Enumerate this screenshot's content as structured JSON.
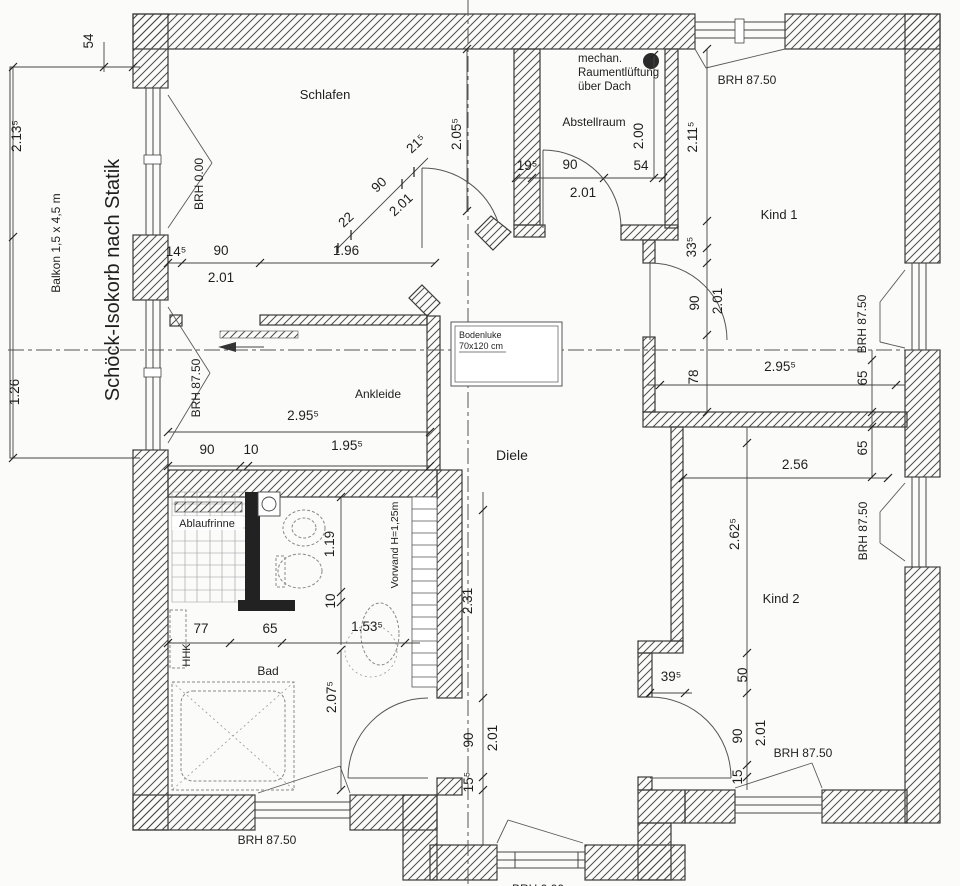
{
  "rooms": {
    "schlafen": "Schlafen",
    "abstellraum": "Abstellraum",
    "kind1": "Kind 1",
    "kind2": "Kind 2",
    "diele": "Diele",
    "ankleide": "Ankleide",
    "bad": "Bad",
    "balkon": "Balkon 1,5 x 4,5 m"
  },
  "annotations": {
    "isokorb": "Schöck-Isokorb nach Statik",
    "vent1": "mechan.",
    "vent2": "Raumentlüftung",
    "vent3": "über Dach",
    "bodenluke1": "Bodenluke",
    "bodenluke2": "70x120 cm",
    "ablaufrinne": "Ablaufrinne",
    "vorwand": "Vorwand H=1,25m",
    "hhk": "HHK"
  },
  "brh": {
    "balkon_tuer": "BRH 0.00",
    "ankleide_fenster": "BRH 87.50",
    "kind1_oben": "BRH 87.50",
    "kind1_rechts": "BRH 87.50",
    "kind2_rechts": "BRH 87.50",
    "kind2_unten": "BRH 87.50",
    "bad_unten": "BRH 87.50",
    "diele_unten": "BRH 0.00"
  },
  "dims": {
    "tl_54": "54",
    "li_2135": "2.13⁵",
    "li_126": "1.26",
    "sch_145": "14⁵",
    "sch_90": "90",
    "sch_196": "1.96",
    "sch_201": "2.01",
    "diag_22": "22",
    "diag_90": "90",
    "diag_215": "21⁵",
    "diag_201": "2.01",
    "ax_2055": "2.05⁵",
    "ab_195": "19⁵",
    "ab_90": "90",
    "ab_54": "54",
    "ab_201": "2.01",
    "ab_200": "2.00",
    "k1_2115": "2.11⁵",
    "k1_335": "33⁵",
    "k1_90": "90",
    "k1_201": "2.01",
    "k1_78": "78",
    "k1_2955": "2.95⁵",
    "k1_65": "65",
    "k2_65": "65",
    "k2_256": "2.56",
    "k2_2625": "2.62⁵",
    "k2_50": "50",
    "k2_395": "39⁵",
    "k2_90": "90",
    "k2_201": "2.01",
    "k2_15": "15",
    "di_231": "2.31",
    "di_90": "90",
    "di_201": "2.01",
    "di_155": "15⁵",
    "an_2955": "2.95⁵",
    "an_90": "90",
    "an_10": "10",
    "an_1955": "1.95⁵",
    "ba_119": "1.19",
    "ba_10": "10",
    "ba_1535": "1.53⁵",
    "ba_77": "77",
    "ba_65": "65",
    "ba_2075": "2.07⁵"
  },
  "palette": {
    "paper": "#fbfbfa",
    "wall_hatch": "#4d4d4d",
    "line": "#3a3a3a",
    "text": "#1f1f1f",
    "fixture": "#888888",
    "vent_dot": "#2a2a2a"
  }
}
